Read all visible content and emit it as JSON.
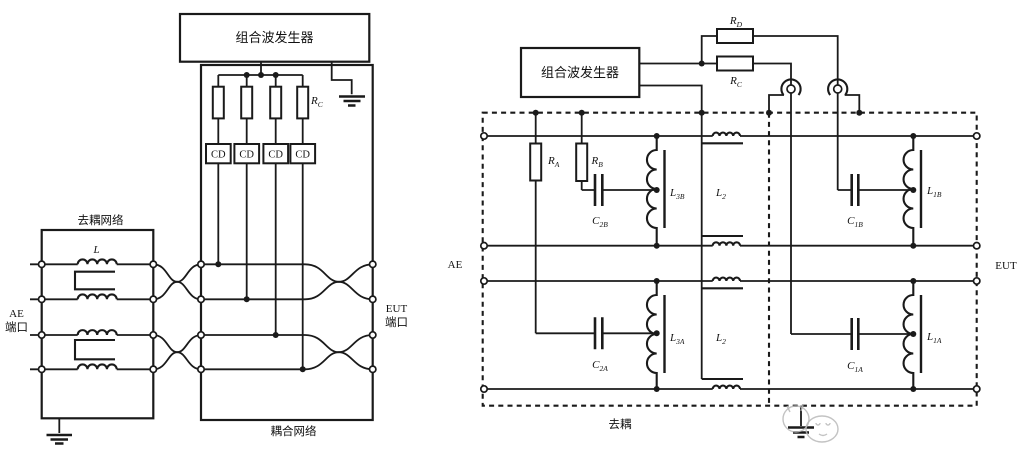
{
  "figure": {
    "left": {
      "generator": "组合波发生器",
      "rc": {
        "b": "R",
        "s": "C"
      },
      "cd": [
        "CD",
        "CD",
        "CD",
        "CD"
      ],
      "inductor": "L",
      "decoupling_network": "去耦网络",
      "coupling_network": "耦合网络",
      "ae_port_line1": "AE",
      "ae_port_line2": "端口",
      "eut_port_line1": "EUT",
      "eut_port_line2": "端口"
    },
    "right": {
      "generator": "组合波发生器",
      "rd": {
        "b": "R",
        "s": "D"
      },
      "rc": {
        "b": "R",
        "s": "C"
      },
      "ra": {
        "b": "R",
        "s": "A"
      },
      "rb": {
        "b": "R",
        "s": "B"
      },
      "c2b": {
        "b": "C",
        "s": "2B"
      },
      "l3b": {
        "b": "L",
        "s": "3B"
      },
      "l2_top": {
        "b": "L",
        "s": "2"
      },
      "c1b": {
        "b": "C",
        "s": "1B"
      },
      "l1b": {
        "b": "L",
        "s": "1B"
      },
      "c2a": {
        "b": "C",
        "s": "2A"
      },
      "l3a": {
        "b": "L",
        "s": "3A"
      },
      "l2_bottom": {
        "b": "L",
        "s": "2"
      },
      "c1a": {
        "b": "C",
        "s": "1A"
      },
      "l1a": {
        "b": "L",
        "s": "1A"
      },
      "ae": "AE",
      "eut": "EUT",
      "decoupling": "去耦"
    },
    "colors": {
      "line": "#1a1a1a",
      "background": "#ffffff",
      "watermark": "#b9b9b9"
    }
  }
}
